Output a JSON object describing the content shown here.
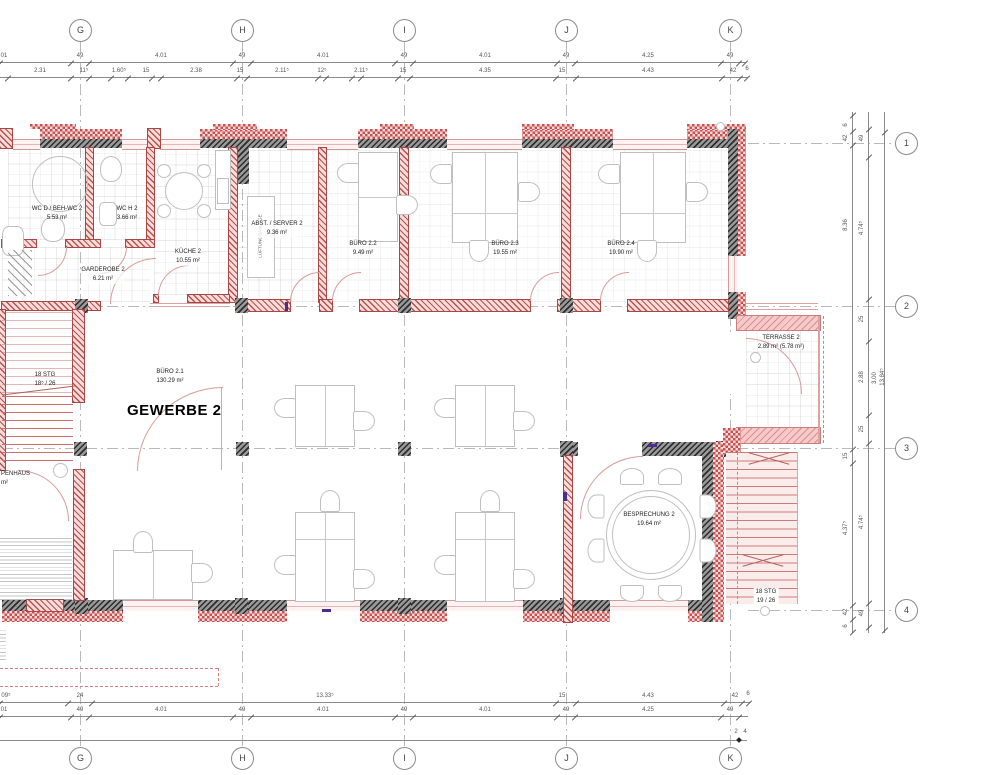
{
  "grid": {
    "cols": [
      "G",
      "H",
      "I",
      "J",
      "K"
    ],
    "rows": [
      "1",
      "2",
      "3",
      "4"
    ]
  },
  "rooms": {
    "wc_d": {
      "name": "WC D / BEH-WC 2",
      "area": "5.53 m²"
    },
    "wc_h": {
      "name": "WC H 2",
      "area": "3.66 m²"
    },
    "kueche": {
      "name": "KÜCHE 2",
      "area": "10.55 m²"
    },
    "garderobe": {
      "name": "GARDEROBE 2",
      "area": "6.21 m²"
    },
    "abstellraum": {
      "name": "ABST. / SERVER 2",
      "area": "9.36 m²"
    },
    "buero_2_2": {
      "name": "BÜRO 2.2",
      "area": "9.49 m²"
    },
    "buero_2_3": {
      "name": "BÜRO 2.3",
      "area": "19.55 m²"
    },
    "buero_2_4": {
      "name": "BÜRO 2.4",
      "area": "19.90 m²"
    },
    "buero_2_1": {
      "name": "BÜRO 2.1",
      "area": "130.29 m²"
    },
    "gewerbe": {
      "name": "GEWERBE 2"
    },
    "besprechung": {
      "name": "BESPRECHUNG 2",
      "area": "19.64 m²"
    },
    "terrasse": {
      "name": "TERRASSE 2",
      "area": "2.89 m² (5.78 m²)"
    },
    "treppenhaus": {
      "name": "PENHAUS",
      "area": "m²"
    },
    "lueftung": {
      "name": "LÜFTUNGSANLAGE"
    }
  },
  "stairs": {
    "left": {
      "line1": "18 STG",
      "line2": "18⁵ / 26"
    },
    "right": {
      "line1": "18 STG",
      "line2": "19 / 26"
    }
  },
  "dims": {
    "top1": [
      "01",
      "49",
      "4.01",
      "49",
      "4.01",
      "49",
      "4.01",
      "49",
      "4.25",
      "49"
    ],
    "top2": [
      "2.31",
      "11⁵",
      "1.60⁵",
      "15",
      "2.38",
      "15",
      "2.11⁵",
      "12⁵",
      "2.11⁵",
      "15",
      "4.35",
      "15",
      "4.43",
      "42",
      "6"
    ],
    "bottom1": [
      "09⁵",
      "24",
      "13.33⁵",
      "15",
      "4.43",
      "42",
      "6"
    ],
    "bottom2": [
      "01",
      "49",
      "4.01",
      "49",
      "4.01",
      "49",
      "4.01",
      "49",
      "4.25",
      "49"
    ],
    "bottom3": [
      "2",
      "4"
    ],
    "right_outer": [
      "6",
      "42",
      "8.36",
      "15",
      "4.37⁵",
      "42",
      "6"
    ],
    "right_inner": [
      "49",
      "4.74⁵",
      "25",
      "2.88",
      "25",
      "4.74⁵",
      "49"
    ],
    "right_mid": [
      "3.00"
    ],
    "right_total": [
      "13.84⁵"
    ]
  },
  "colors": {
    "wall_dark": "#5a5a5a",
    "wall_brick": "#b15450",
    "insulation": "#cb4f4d",
    "window_frame": "#cf9b99",
    "marker_purple": "#4a2d8f"
  }
}
